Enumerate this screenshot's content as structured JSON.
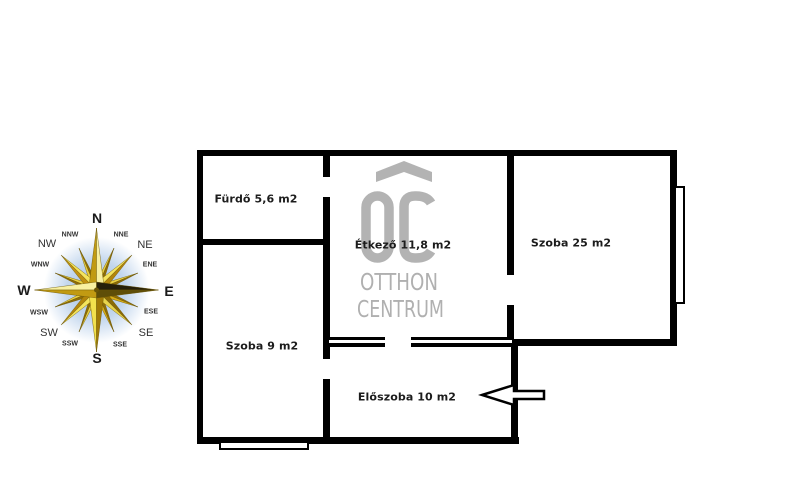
{
  "floorplan": {
    "rooms": [
      {
        "name": "bathroom",
        "label": "Fürdő 5,6 m2"
      },
      {
        "name": "dining-room",
        "label": "Étkező 11,8 m2"
      },
      {
        "name": "room-25",
        "label": "Szoba 25 m2"
      },
      {
        "name": "room-9",
        "label": "Szoba 9 m2"
      },
      {
        "name": "hallway",
        "label": "Előszoba 10 m2"
      }
    ],
    "entrance_arrow_icon": "arrow-left"
  },
  "watermark": {
    "monogram": "OC",
    "line1": "OTTHON",
    "line2": "CENTRUM",
    "color": "#b3b3b3"
  },
  "compass": {
    "labels": {
      "n": "N",
      "nne": "NNE",
      "ne": "NE",
      "ene": "ENE",
      "e": "E",
      "ese": "ESE",
      "se": "SE",
      "sse": "SSE",
      "s": "S",
      "ssw": "SSW",
      "sw": "SW",
      "wsw": "WSW",
      "w": "W",
      "wnw": "WNW",
      "nw": "NW",
      "nnw": "NNW"
    }
  },
  "colors": {
    "wall": "#000000",
    "room_label_text": "#1c1c1c",
    "compass_gold_dark": "#8f6d05",
    "compass_gold": "#c19a12",
    "compass_yellow_light": "#f2e14d",
    "compass_glow_blue": "#a9c6e8",
    "watermark_gray": "#b3b3b3"
  }
}
